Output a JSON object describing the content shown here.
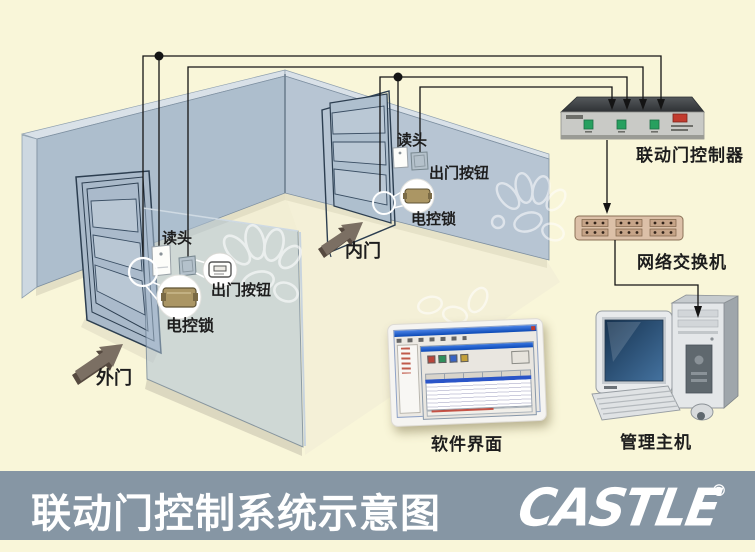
{
  "room": {
    "outer": {
      "door_label": "外门",
      "reader": "读头",
      "exit_button": "出门按钮",
      "lock": "电控锁"
    },
    "inner": {
      "door_label": "内门",
      "reader": "读头",
      "exit_button": "出门按钮",
      "lock": "电控锁"
    }
  },
  "equipment": {
    "controller": {
      "label": "联动门控制器"
    },
    "network_switch": {
      "label": "网络交换机"
    },
    "software": {
      "label": "软件界面"
    },
    "host": {
      "label": "管理主机"
    }
  },
  "footer": {
    "title": "联动门控制系统示意图",
    "brand": "CASTLE",
    "registered_mark": "®"
  },
  "colors": {
    "background": "#f9f6d9",
    "wall": "#afc0cf",
    "wall_light": "#b9c7d5",
    "wall_edge_cap": "#d9e1e8",
    "glass_partition": "rgba(173,192,210,0.55)",
    "floor": "#f2eed4",
    "wire": "#141414",
    "footer_bar": "#8696a4",
    "label_text": "#1d1d1d",
    "footer_text": "#ffffff",
    "controller_body": "#c9cac6",
    "controller_top": "#3b3f42",
    "controller_button_green": "#27a05f",
    "controller_button_red": "#c23b2e",
    "switch_body": "#dcc0a8",
    "switch_port": "#c6a488",
    "lock_body": "#ab9664",
    "monitor_screen": "#1d3a5c",
    "arrow_icon": "#7b6f63"
  }
}
